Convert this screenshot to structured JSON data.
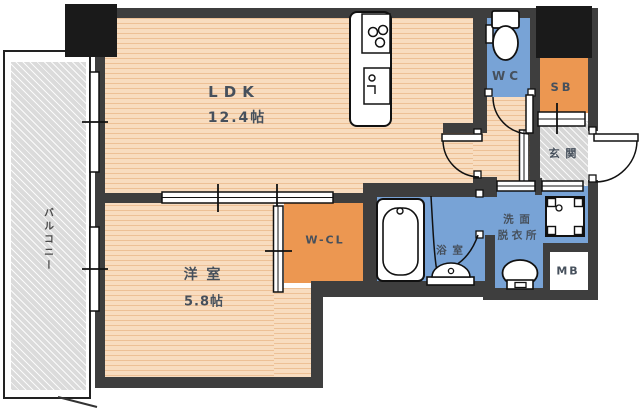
{
  "title": "マンション間取り図",
  "rooms": {
    "ldk": {
      "label": "LDK",
      "size": "12.4帖"
    },
    "bedroom": {
      "label": "洋 室",
      "size": "5.8帖"
    },
    "closet": {
      "label": "W-CL"
    },
    "toilet": {
      "label": "WC"
    },
    "shoebox": {
      "label": "SB"
    },
    "entrance": {
      "label": "玄 関"
    },
    "bathroom": {
      "label": "浴 室"
    },
    "washroom": {
      "label_line1": "洗 面",
      "label_line2": "脱 衣 所"
    },
    "meterbox": {
      "label": "MB"
    },
    "balcony": {
      "label": "バルコニー"
    }
  },
  "fixtures": {
    "kitchen_counter": "kitchen-counter-icon",
    "stove": "stove-burners-icon",
    "kitchen_sink": "kitchen-sink-icon",
    "toilet": "toilet-icon",
    "bathtub": "bathtub-icon",
    "bath_counter": "bath-washbasin-icon",
    "washbasin": "vanity-sink-icon",
    "washer_pan": "washing-machine-pan-icon"
  },
  "colors": {
    "wall": "#3E3E3E",
    "pillar": "#1A1A1A",
    "floor": "#F8DCBF",
    "storage_orange": "#EC9751",
    "water_blue": "#78A3D6",
    "balcony_gray": "#DBDBDB",
    "label": "#46505C"
  }
}
